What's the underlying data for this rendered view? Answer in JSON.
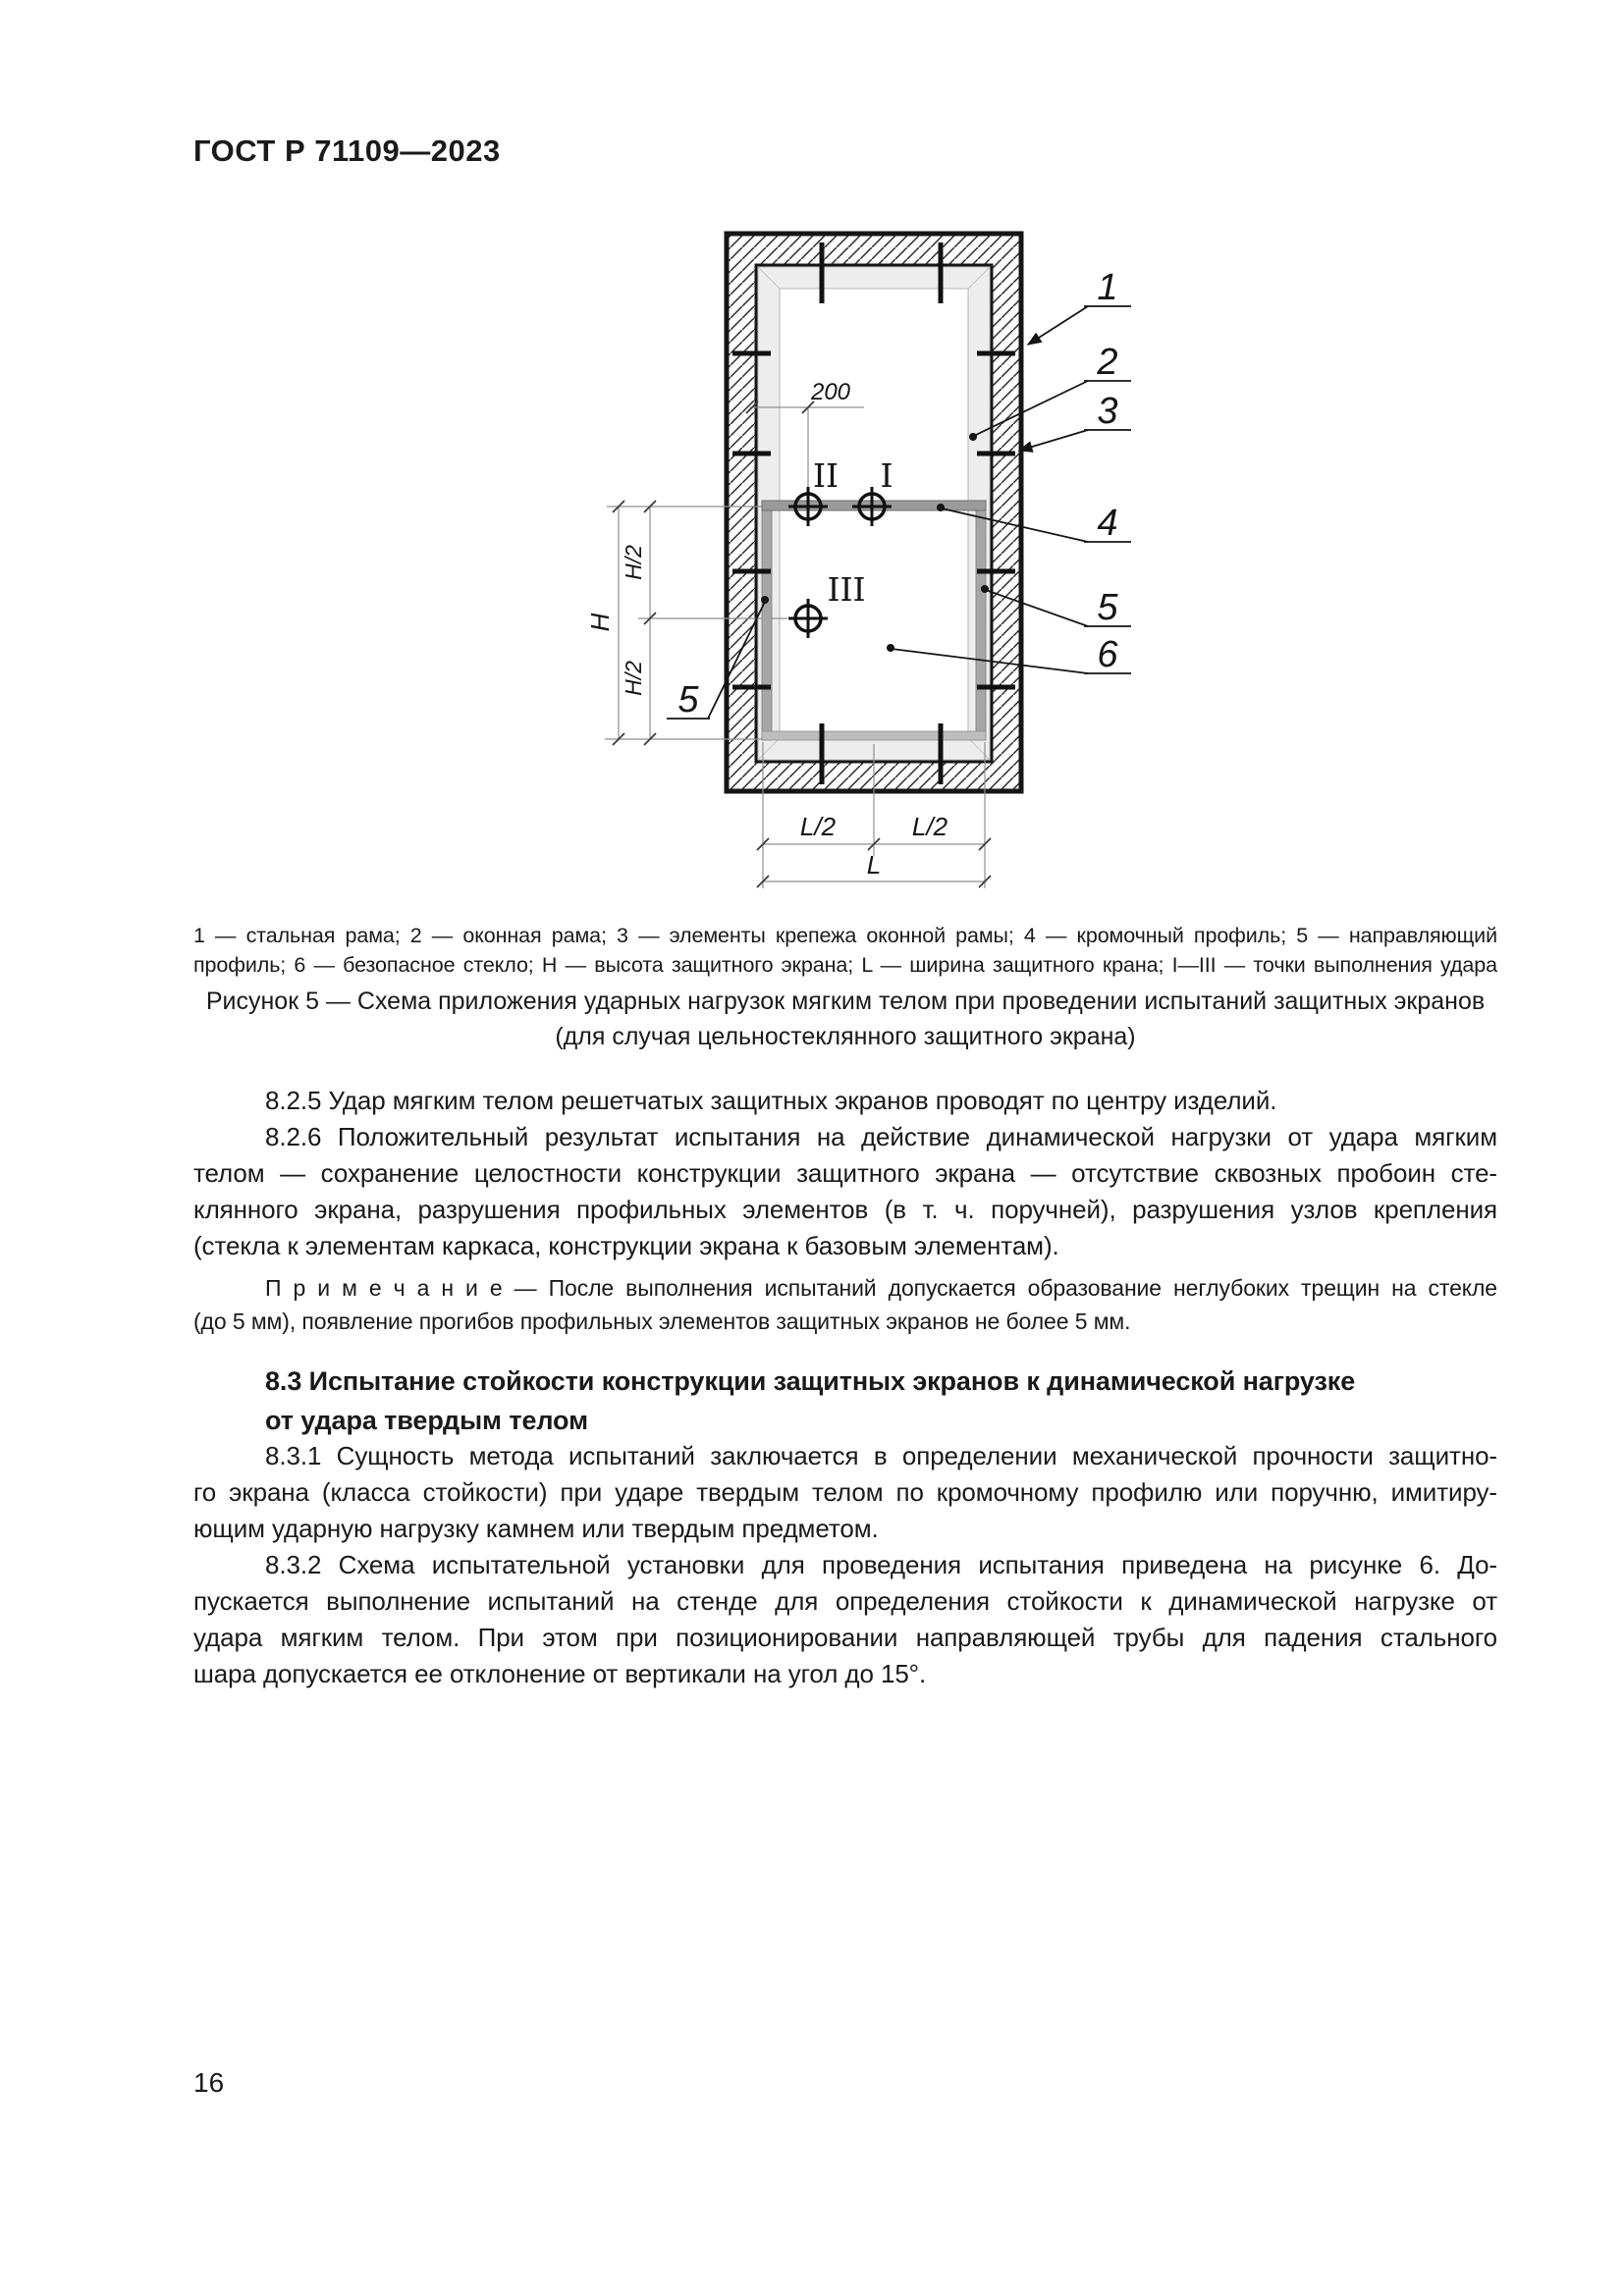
{
  "page": {
    "header": "ГОСТ Р 71109—2023",
    "number": "16"
  },
  "colors": {
    "ink": "#1a1a1a",
    "profile_gray": "#9a9a9a",
    "frame_fill": "#ededed"
  },
  "figure": {
    "callouts": {
      "n1": "1",
      "n2": "2",
      "n3": "3",
      "n4": "4",
      "n5_right": "5",
      "n5_left": "5",
      "n6": "6"
    },
    "points": {
      "p1": "I",
      "p2": "II",
      "p3": "III"
    },
    "dims": {
      "d200": "200",
      "h_half_top": "H/2",
      "h": "H",
      "h_half_bottom": "H/2",
      "l_half_left": "L/2",
      "l_half_right": "L/2",
      "l": "L"
    },
    "legend_lines": [
      "1 — стальная рама; 2 — оконная рама; 3 — элементы крепежа оконной рамы; 4 — кромочный профиль; 5 — направляющий",
      "профиль; 6 — безопасное стекло; Н — высота защитного экрана; L — ширина защитного крана; I—III — точки выполнения удара"
    ],
    "caption_lines": [
      "Рисунок 5 — Схема приложения ударных нагрузок мягким телом при проведении испытаний защитных экранов",
      "(для случая цельностеклянного защитного экрана)"
    ]
  },
  "body": {
    "p825": [
      "8.2.5 Удар мягким телом решетчатых защитных экранов проводят по центру изделий."
    ],
    "p826": [
      "8.2.6 Положительный результат испытания на действие динамической нагрузки от удара мягким",
      "телом — сохранение целостности конструкции защитного экрана — отсутствие сквозных пробоин сте-",
      "клянного экрана, разрушения профильных элементов (в т. ч. поручней), разрушения узлов крепления",
      "(стекла к элементам каркаса, конструкции экрана к базовым элементам)."
    ],
    "note": [
      "П р и м е ч а н и е — После выполнения испытаний допускается образование неглубоких трещин на стекле",
      "(до 5 мм), появление прогибов профильных элементов защитных экранов не более 5 мм."
    ],
    "h83": [
      "8.3 Испытание стойкости конструкции защитных экранов к динамической нагрузке",
      "от удара твердым телом"
    ],
    "p831": [
      "8.3.1 Сущность метода испытаний заключается в определении механической прочности защитно-",
      "го экрана (класса стойкости) при ударе твердым телом по кромочному профилю или поручню, имитиру-",
      "ющим ударную нагрузку камнем или твердым предметом."
    ],
    "p832": [
      "8.3.2 Схема испытательной установки для проведения испытания приведена на рисунке 6. До-",
      "пускается выполнение испытаний на стенде для определения стойкости к динамической нагрузке от",
      "удара мягким телом. При этом при позиционировании направляющей трубы для падения стального",
      "шара допускается ее отклонение от вертикали на угол до 15°."
    ]
  }
}
